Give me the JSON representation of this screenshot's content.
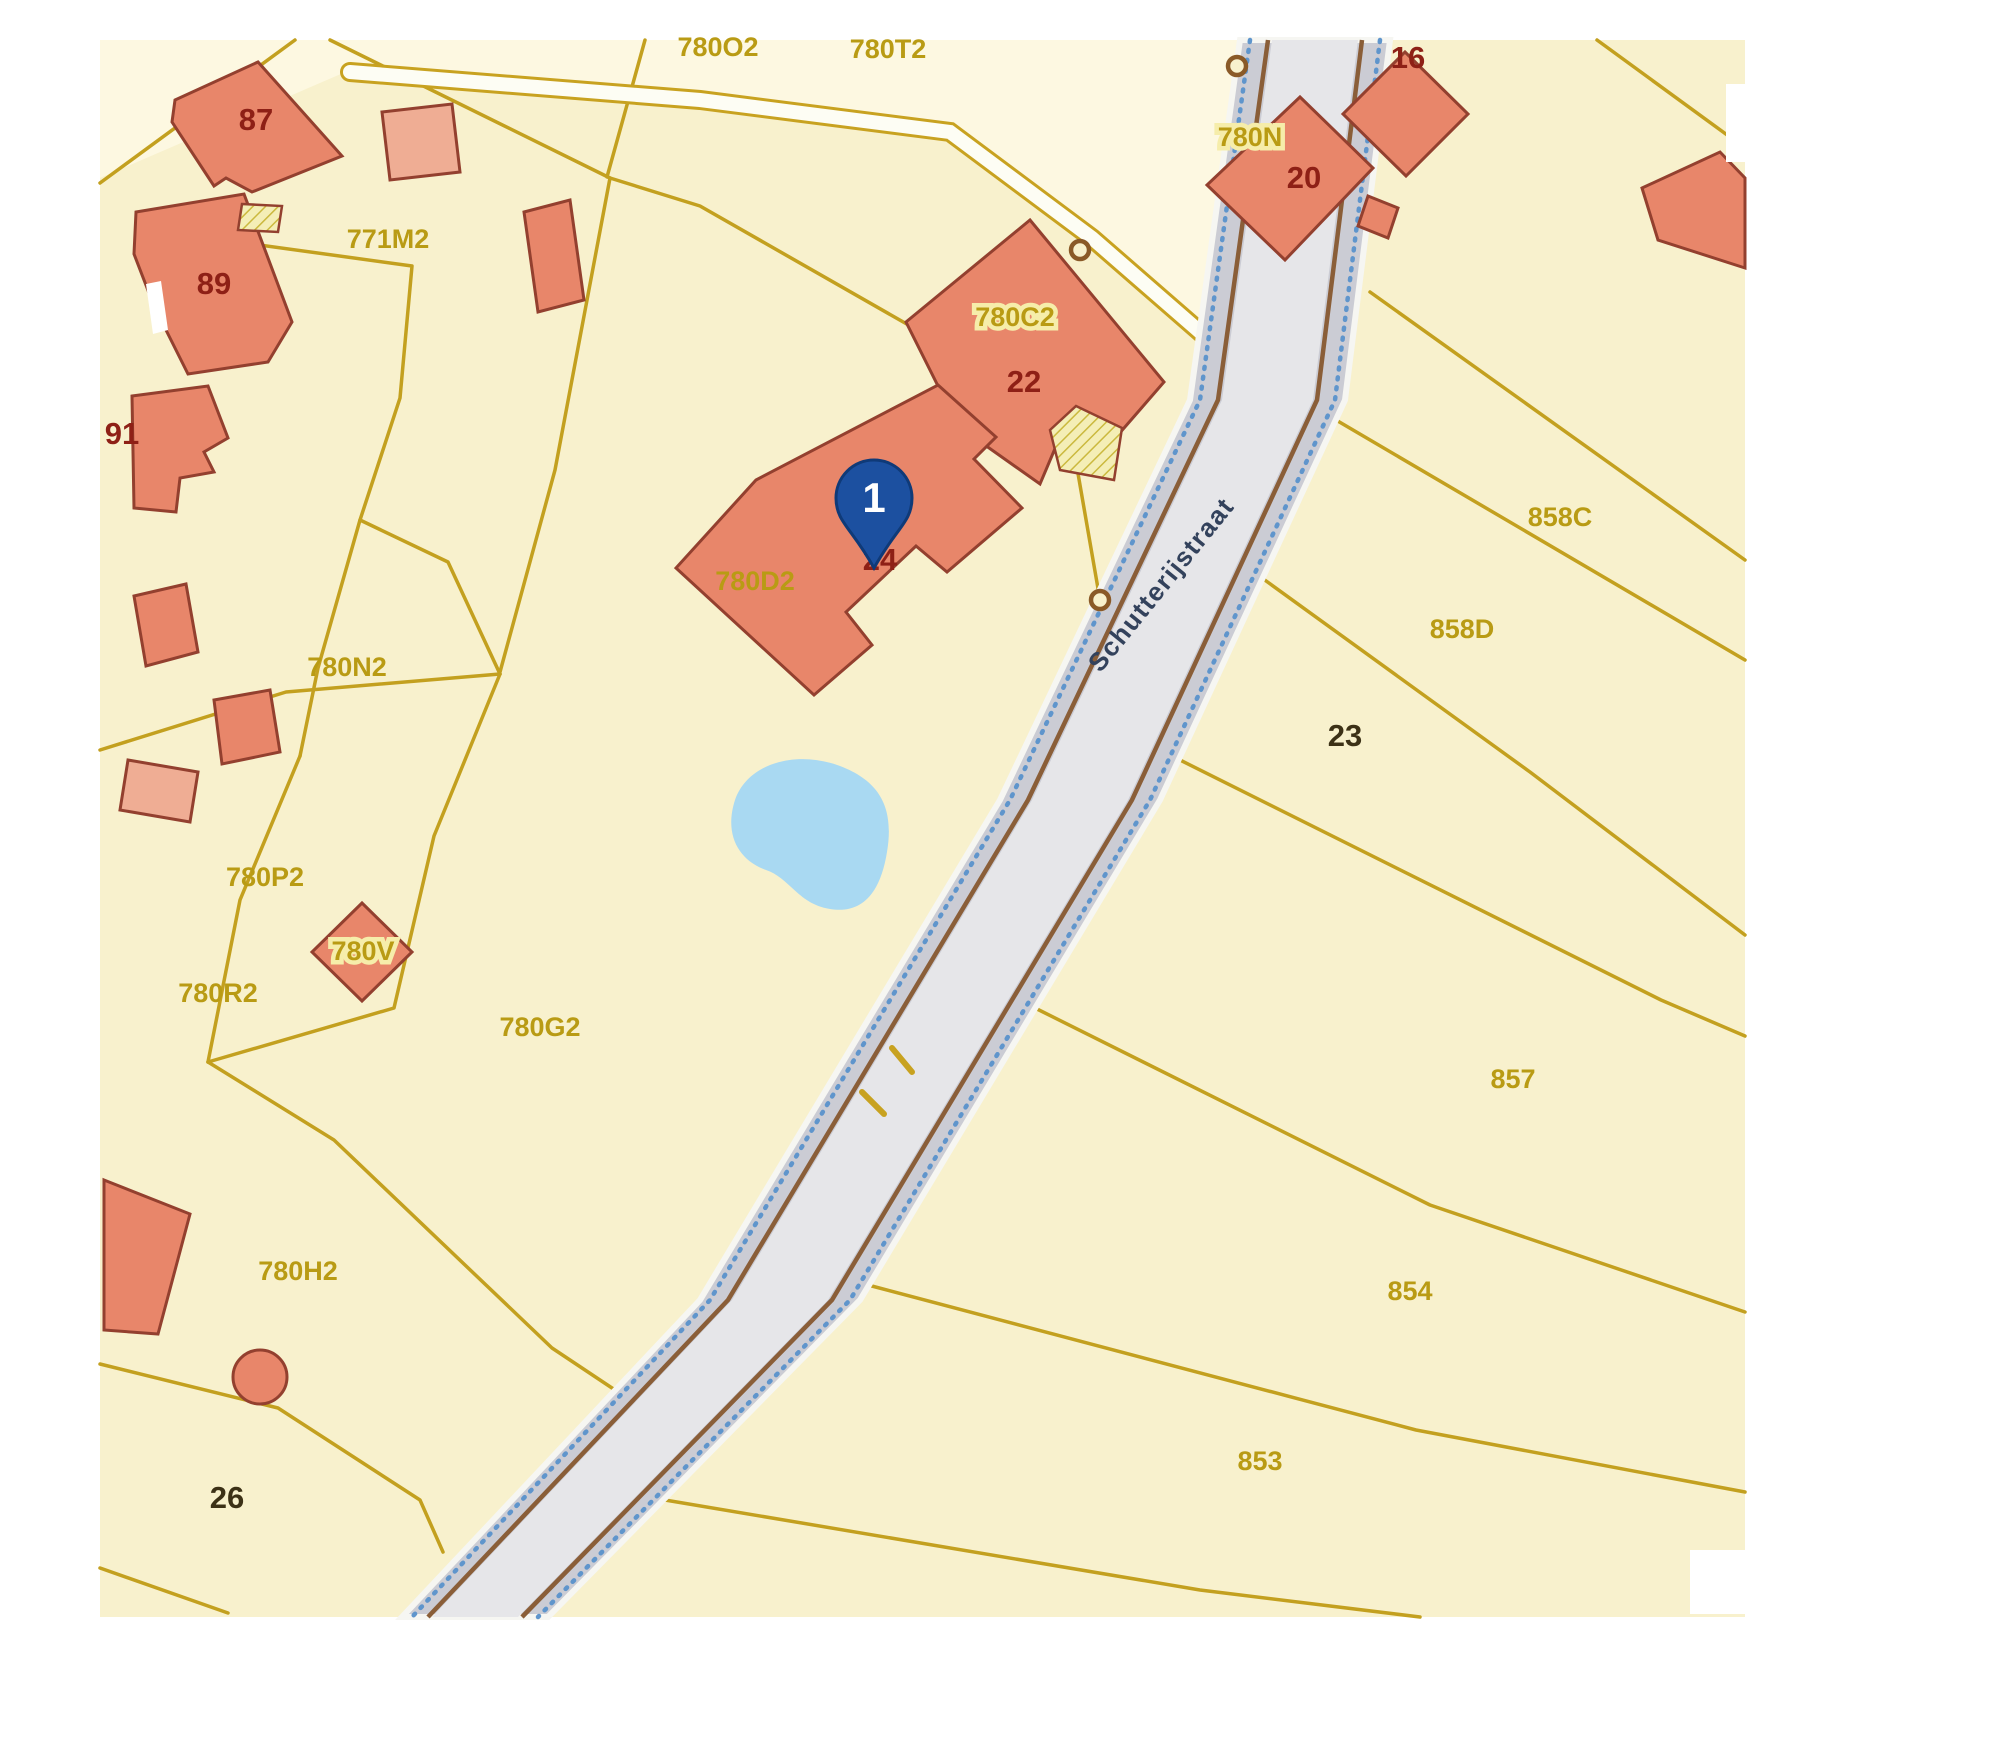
{
  "map": {
    "road": {
      "name": "Schutterijstraat"
    },
    "marker": {
      "label": "1"
    },
    "parcel_labels": [
      {
        "id": "780O2",
        "text": "780O2",
        "x": 718,
        "y": 56,
        "plate": false
      },
      {
        "id": "780T2",
        "text": "780T2",
        "x": 888,
        "y": 58,
        "plate": false
      },
      {
        "id": "771M2",
        "text": "771M2",
        "x": 388,
        "y": 248,
        "plate": false
      },
      {
        "id": "780N",
        "text": "780N",
        "x": 1250,
        "y": 146,
        "plate": true
      },
      {
        "id": "780C2",
        "text": "780C2",
        "x": 1015,
        "y": 326,
        "plate": true
      },
      {
        "id": "780D2",
        "text": "780D2",
        "x": 755,
        "y": 590,
        "plate": false
      },
      {
        "id": "780N2",
        "text": "780N2",
        "x": 347,
        "y": 676,
        "plate": false
      },
      {
        "id": "780P2",
        "text": "780P2",
        "x": 265,
        "y": 886,
        "plate": false
      },
      {
        "id": "780V",
        "text": "780V",
        "x": 363,
        "y": 960,
        "plate": true
      },
      {
        "id": "780R2",
        "text": "780R2",
        "x": 218,
        "y": 1002,
        "plate": false
      },
      {
        "id": "780G2",
        "text": "780G2",
        "x": 540,
        "y": 1036,
        "plate": false
      },
      {
        "id": "780H2",
        "text": "780H2",
        "x": 298,
        "y": 1280,
        "plate": false
      },
      {
        "id": "858C",
        "text": "858C",
        "x": 1560,
        "y": 526,
        "plate": false
      },
      {
        "id": "858D",
        "text": "858D",
        "x": 1462,
        "y": 638,
        "plate": false
      },
      {
        "id": "857",
        "text": "857",
        "x": 1513,
        "y": 1088,
        "plate": false
      },
      {
        "id": "854",
        "text": "854",
        "x": 1410,
        "y": 1300,
        "plate": false
      },
      {
        "id": "853",
        "text": "853",
        "x": 1260,
        "y": 1470,
        "plate": false
      }
    ],
    "house_numbers": [
      {
        "text": "87",
        "x": 256,
        "y": 130,
        "dark": false
      },
      {
        "text": "89",
        "x": 214,
        "y": 294,
        "dark": false
      },
      {
        "text": "91",
        "x": 122,
        "y": 444,
        "dark": false
      },
      {
        "text": "16",
        "x": 1408,
        "y": 68,
        "dark": false
      },
      {
        "text": "20",
        "x": 1304,
        "y": 188,
        "dark": false
      },
      {
        "text": "22",
        "x": 1024,
        "y": 392,
        "dark": false
      },
      {
        "text": "24",
        "x": 880,
        "y": 570,
        "dark": false
      },
      {
        "text": "23",
        "x": 1345,
        "y": 746,
        "dark": true
      },
      {
        "text": "26",
        "x": 227,
        "y": 1508,
        "dark": true
      }
    ],
    "colors": {
      "map_background": "#f8f1cd",
      "map_background_light": "#fdf8e1",
      "parcel_line": "#c3a01f",
      "building_fill": "#e8866a",
      "building_fill_light": "#efad94",
      "building_stroke": "#93402f",
      "parcel_label": "#b99b14",
      "house_number": "#8e2016",
      "house_number_dark": "#3c3116",
      "road_fill": "#cbccd4",
      "road_edge_brown": "#8a5e38",
      "road_dotted_blue": "#5f95cc",
      "road_name_text": "#33425c",
      "pond": "#a9d9f2",
      "marker_blue": "#1c50a0"
    }
  }
}
